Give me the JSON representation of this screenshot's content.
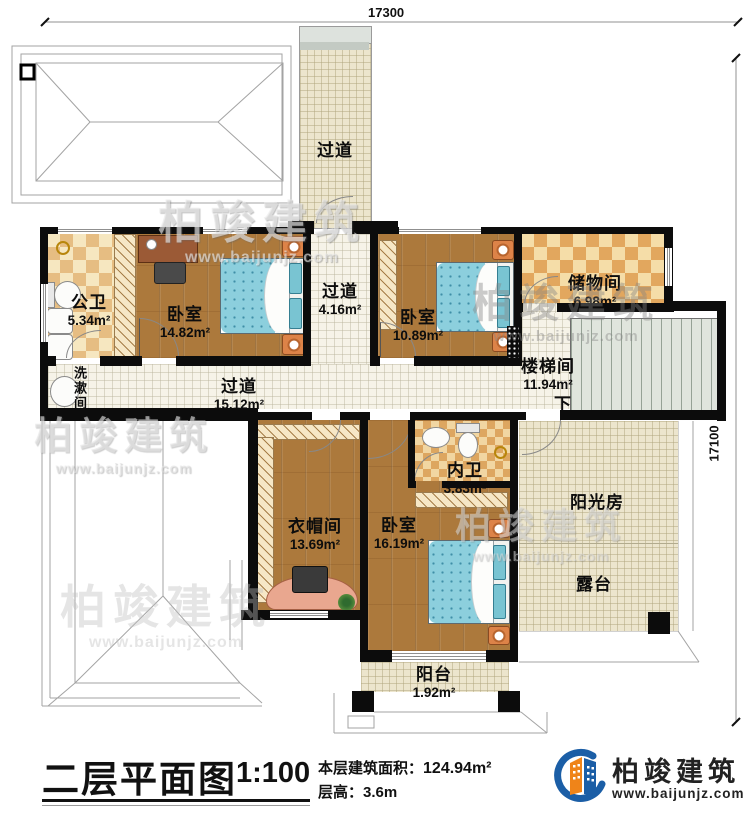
{
  "dimensions": {
    "top": "17300",
    "right": "17100"
  },
  "rooms": [
    {
      "id": "corridor-top",
      "name": "过道",
      "area": ""
    },
    {
      "id": "public-bath",
      "name": "公卫",
      "area": "5.34m²"
    },
    {
      "id": "bedroom-1",
      "name": "卧室",
      "area": "14.82m²"
    },
    {
      "id": "corridor-small",
      "name": "过道",
      "area": "4.16m²"
    },
    {
      "id": "bedroom-2",
      "name": "卧室",
      "area": "10.89m²"
    },
    {
      "id": "storage",
      "name": "储物间",
      "area": "6.98m²"
    },
    {
      "id": "stairwell",
      "name": "楼梯间",
      "area": "11.94m²"
    },
    {
      "id": "washroom",
      "name": "洗漱间",
      "area": ""
    },
    {
      "id": "corridor-main",
      "name": "过道",
      "area": "15.12m²"
    },
    {
      "id": "cloakroom",
      "name": "衣帽间",
      "area": "13.69m²"
    },
    {
      "id": "ensuite-bath",
      "name": "内卫",
      "area": "3.83m²"
    },
    {
      "id": "bedroom-3",
      "name": "卧室",
      "area": "16.19m²"
    },
    {
      "id": "sunroom",
      "name": "阳光房",
      "area": ""
    },
    {
      "id": "terrace",
      "name": "露台",
      "area": ""
    },
    {
      "id": "balcony",
      "name": "阳台",
      "area": "1.92m²"
    }
  ],
  "stairs": {
    "down_label": "下"
  },
  "title": {
    "name": "二层平面图",
    "scale": "1:100",
    "area_label": "本层建筑面积：",
    "area_value": "124.94m²",
    "height_label": "层高：",
    "height_value": "3.6m"
  },
  "brand": {
    "name": "柏竣建筑",
    "url": "www.baijunjz.com"
  },
  "watermark": {
    "name": "柏竣建筑",
    "url": "www.baijunjz.com"
  },
  "colors": {
    "wall": "#0c0c0c",
    "wood": "#ac793c",
    "tile_beige": "#ece5cd",
    "accent_blue": "#1b5ea6",
    "accent_orange": "#ef8419"
  }
}
